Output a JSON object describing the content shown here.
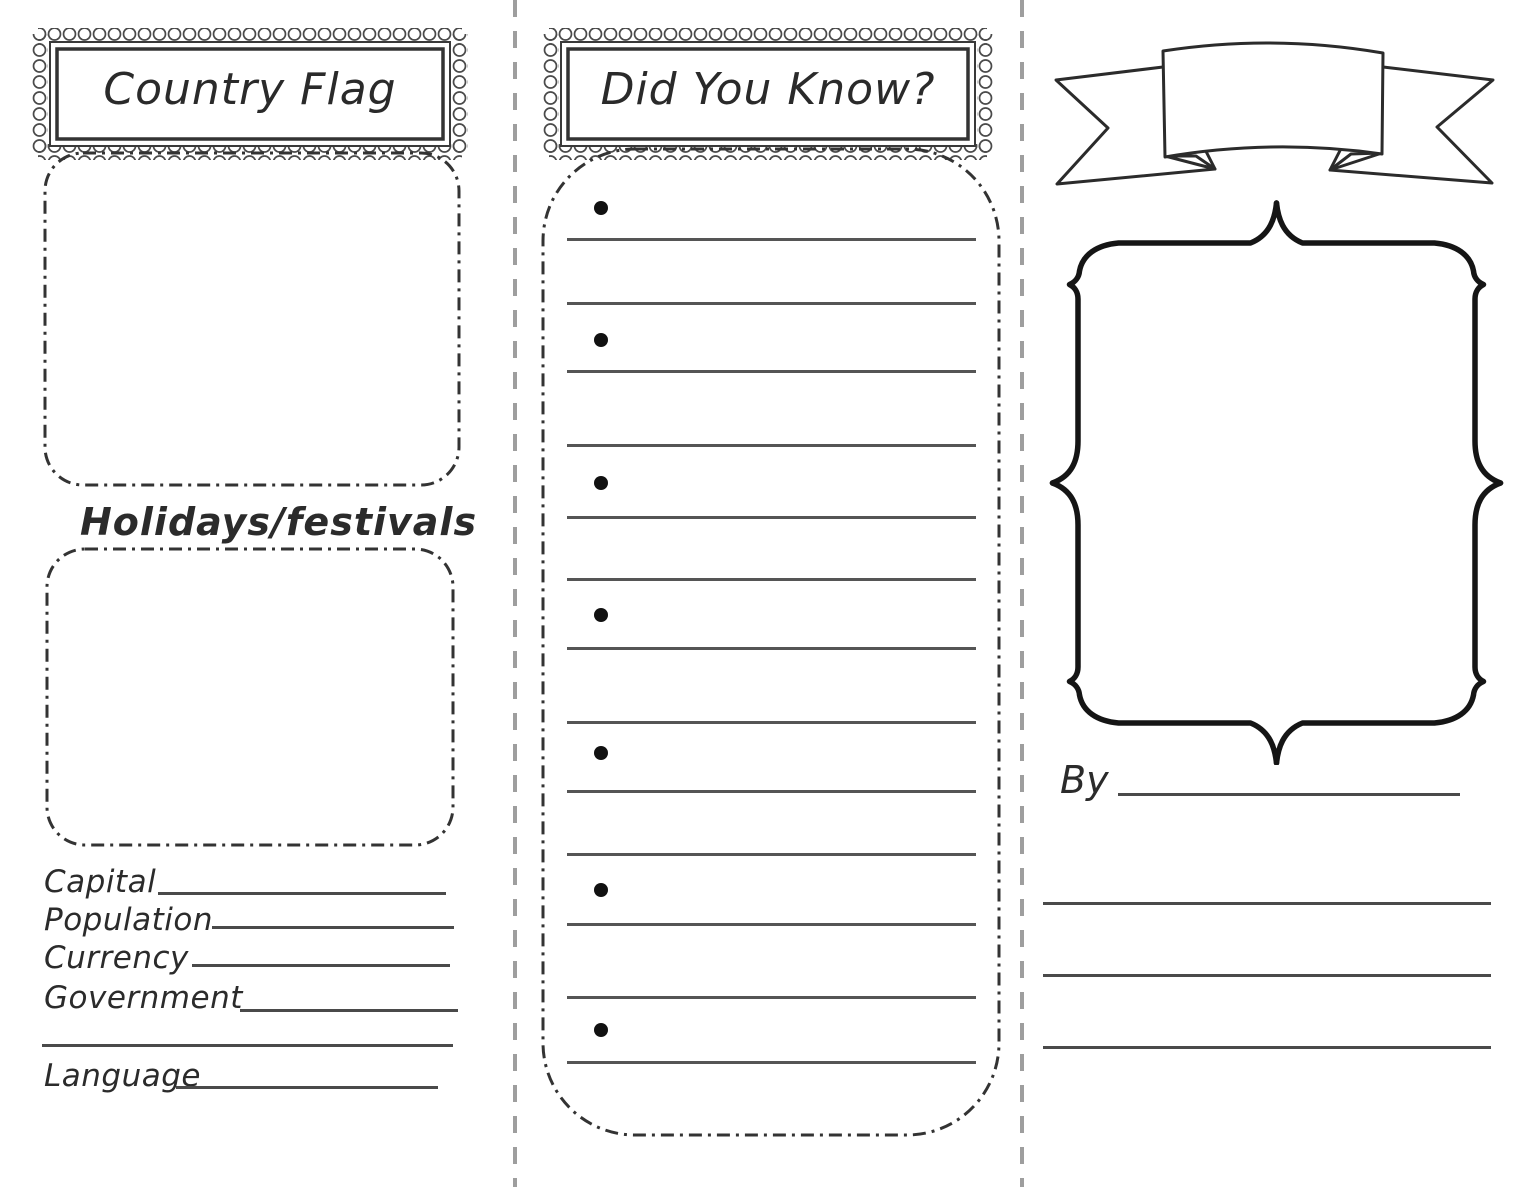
{
  "colors": {
    "ink": "#2a2a2a",
    "rule_line": "#4a4a4a",
    "fold_line": "#9e9e9e",
    "background": "#ffffff"
  },
  "panels": {
    "left": {
      "title": "Country Flag",
      "section_heading": "Holidays/festivals",
      "fields": [
        {
          "label": "Capital"
        },
        {
          "label": "Population"
        },
        {
          "label": "Currency"
        },
        {
          "label": "Government"
        },
        {
          "label": ""
        },
        {
          "label": "Language"
        }
      ]
    },
    "middle": {
      "title": "Did You Know?",
      "bullet_count": 7,
      "ruled_line_count": 13
    },
    "right": {
      "banner_text": "",
      "by_label": "By",
      "footer_line_count": 3
    }
  }
}
